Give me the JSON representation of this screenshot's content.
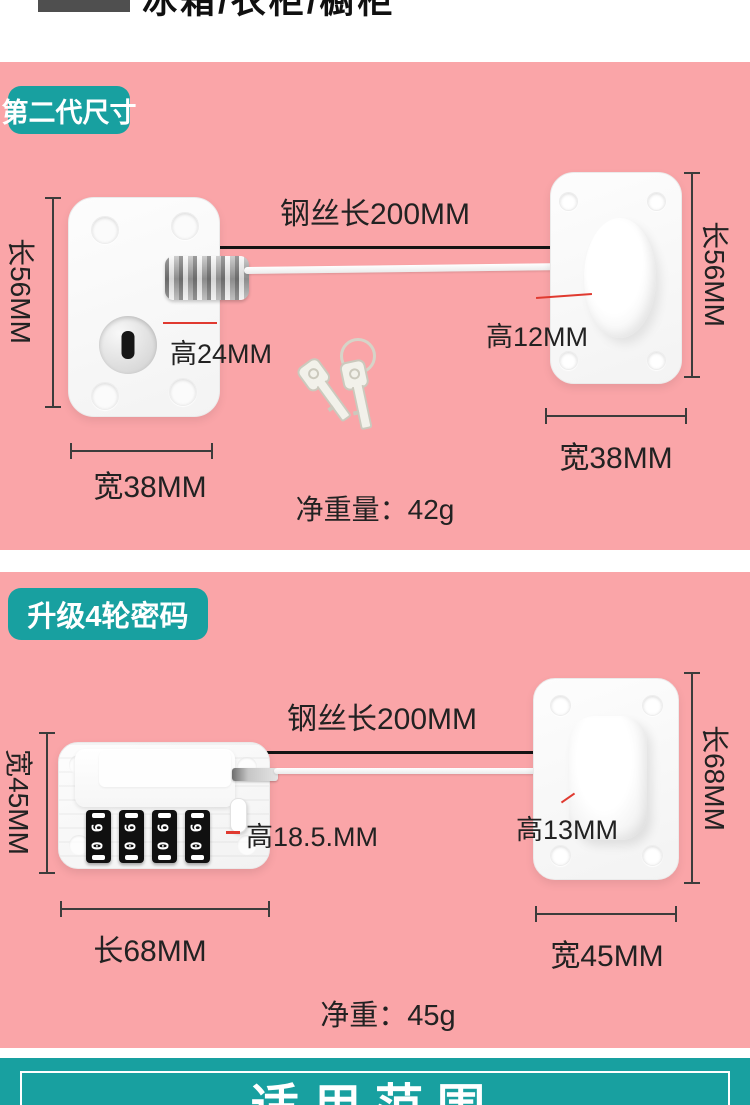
{
  "colors": {
    "pink": "#faa5a8",
    "teal": "#18a0a0",
    "red": "#e03a30",
    "text": "#2b2b2b"
  },
  "top_strip": {
    "clipped_text": "冰箱/衣柜/橱柜"
  },
  "section1": {
    "badge": "第二代尺寸",
    "wire_length": "钢丝长200MM",
    "side_length_left": "长56MM",
    "side_length_right": "长56MM",
    "lock_height": "高24MM",
    "anchor_height": "高12MM",
    "width_left": "宽38MM",
    "width_right": "宽38MM",
    "net_weight": "净重量：42g"
  },
  "section2": {
    "badge": "升级4轮密码",
    "wire_length": "钢丝长200MM",
    "side_width_left": "宽45MM",
    "lock_height": "高18.5.MM",
    "anchor_height": "高13MM",
    "length_bottom": "长68MM",
    "side_length_right": "长68MM",
    "width_bottom": "宽45MM",
    "net_weight": "净重：45g",
    "dial_digit_a": "6",
    "dial_digit_b": "0"
  },
  "banner": {
    "title": "适用范围"
  }
}
